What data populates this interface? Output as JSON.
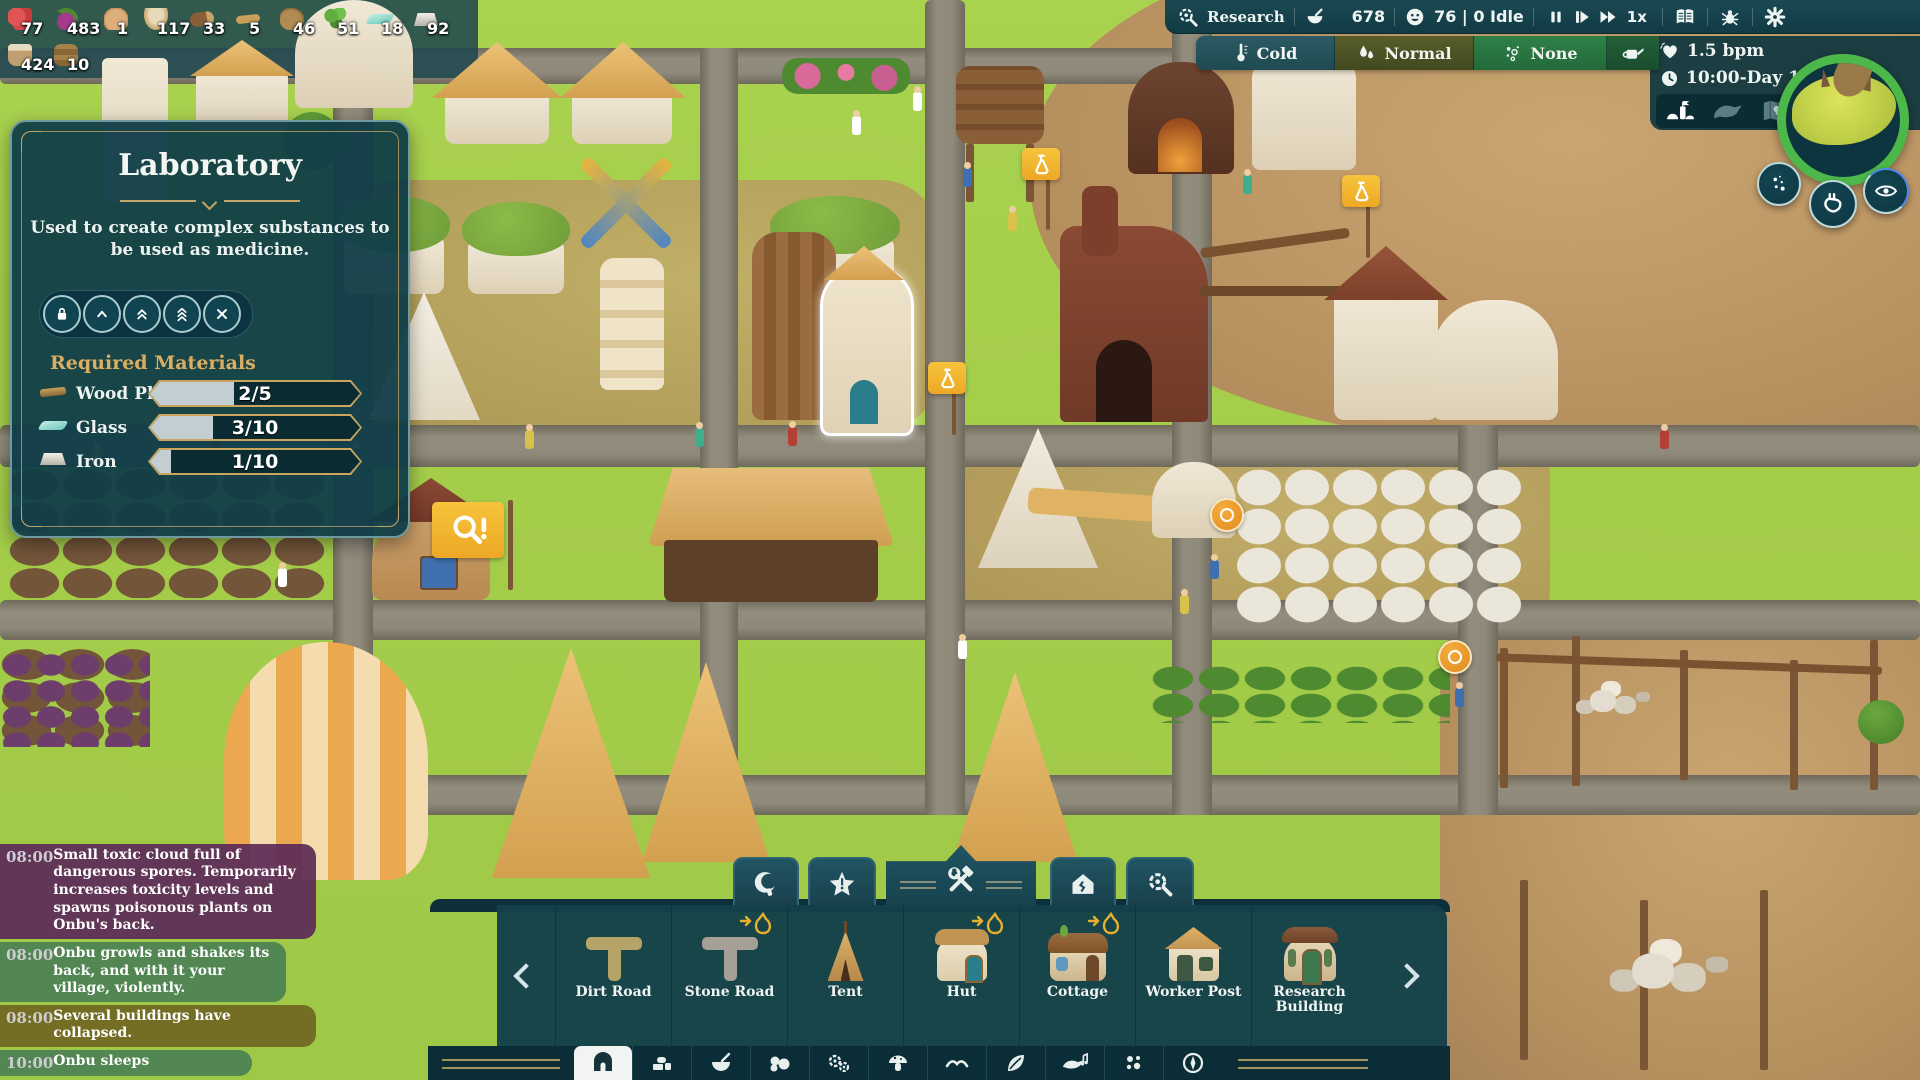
{
  "resources": {
    "row1": [
      {
        "name": "berries",
        "count": "77"
      },
      {
        "name": "beetroot",
        "count": "483"
      },
      {
        "name": "bread",
        "count": "1"
      },
      {
        "name": "porridge",
        "count": "117"
      },
      {
        "name": "wood-log",
        "count": "33"
      },
      {
        "name": "wood-plank",
        "count": "5"
      },
      {
        "name": "roots",
        "count": "46"
      },
      {
        "name": "herbs",
        "count": "51"
      },
      {
        "name": "glass",
        "count": "18"
      },
      {
        "name": "iron",
        "count": "92"
      }
    ],
    "row2": [
      {
        "name": "clay-pot",
        "count": "424"
      },
      {
        "name": "water-barrel",
        "count": "10"
      }
    ]
  },
  "tooltip": {
    "title": "Laboratory",
    "description": "Used to create complex substances to be used as medicine.",
    "materials_header": "Required Materials",
    "materials": [
      {
        "name": "Wood Plank",
        "value": "2/5",
        "fill": "40%"
      },
      {
        "name": "Glass",
        "value": "3/10",
        "fill": "30%"
      },
      {
        "name": "Iron",
        "value": "1/10",
        "fill": "10%"
      }
    ]
  },
  "topbar": {
    "research_label": "Research",
    "research_points": "678",
    "population": "76 | 0 Idle",
    "speed_label": "1x"
  },
  "weather": {
    "temperature_label": "Cold",
    "humidity_label": "Normal",
    "toxicity_label": "None"
  },
  "status": {
    "heart_rate": "1.5 bpm",
    "time_day": "10:00-Day 18"
  },
  "events": [
    {
      "time": "08:00",
      "text": "Small toxic cloud full of dangerous spores. Temporarily increases toxicity levels and spawns poisonous plants on Onbu's back.",
      "color": "rgba(92,43,87,0.93)"
    },
    {
      "time": "08:00",
      "text": "Onbu growls and shakes its back, and with it your village, violently.",
      "color": "rgba(76,129,83,0.93)"
    },
    {
      "time": "08:00",
      "text": "Several buildings have collapsed.",
      "color": "rgba(113,103,34,0.93)"
    },
    {
      "time": "10:00",
      "text": "Onbu sleeps",
      "color": "rgba(76,129,83,0.93)"
    }
  ],
  "build_menu": {
    "items": [
      {
        "label": "Dirt Road",
        "cost_badge": false
      },
      {
        "label": "Stone Road",
        "cost_badge": true
      },
      {
        "label": "Tent",
        "cost_badge": false
      },
      {
        "label": "Hut",
        "cost_badge": true
      },
      {
        "label": "Cottage",
        "cost_badge": true
      },
      {
        "label": "Worker Post",
        "cost_badge": false
      },
      {
        "label": "Research Building",
        "cost_badge": false
      }
    ]
  },
  "colors": {
    "panel_teal": "#0f3d47",
    "gold": "#c9a55f",
    "flag_yellow": "#f2b52b",
    "minimap_ring": "#4db84a",
    "weather_cold_bg": "#27535c",
    "weather_normal_bg": "#4d5226",
    "weather_none_bg": "#2b7a44"
  }
}
